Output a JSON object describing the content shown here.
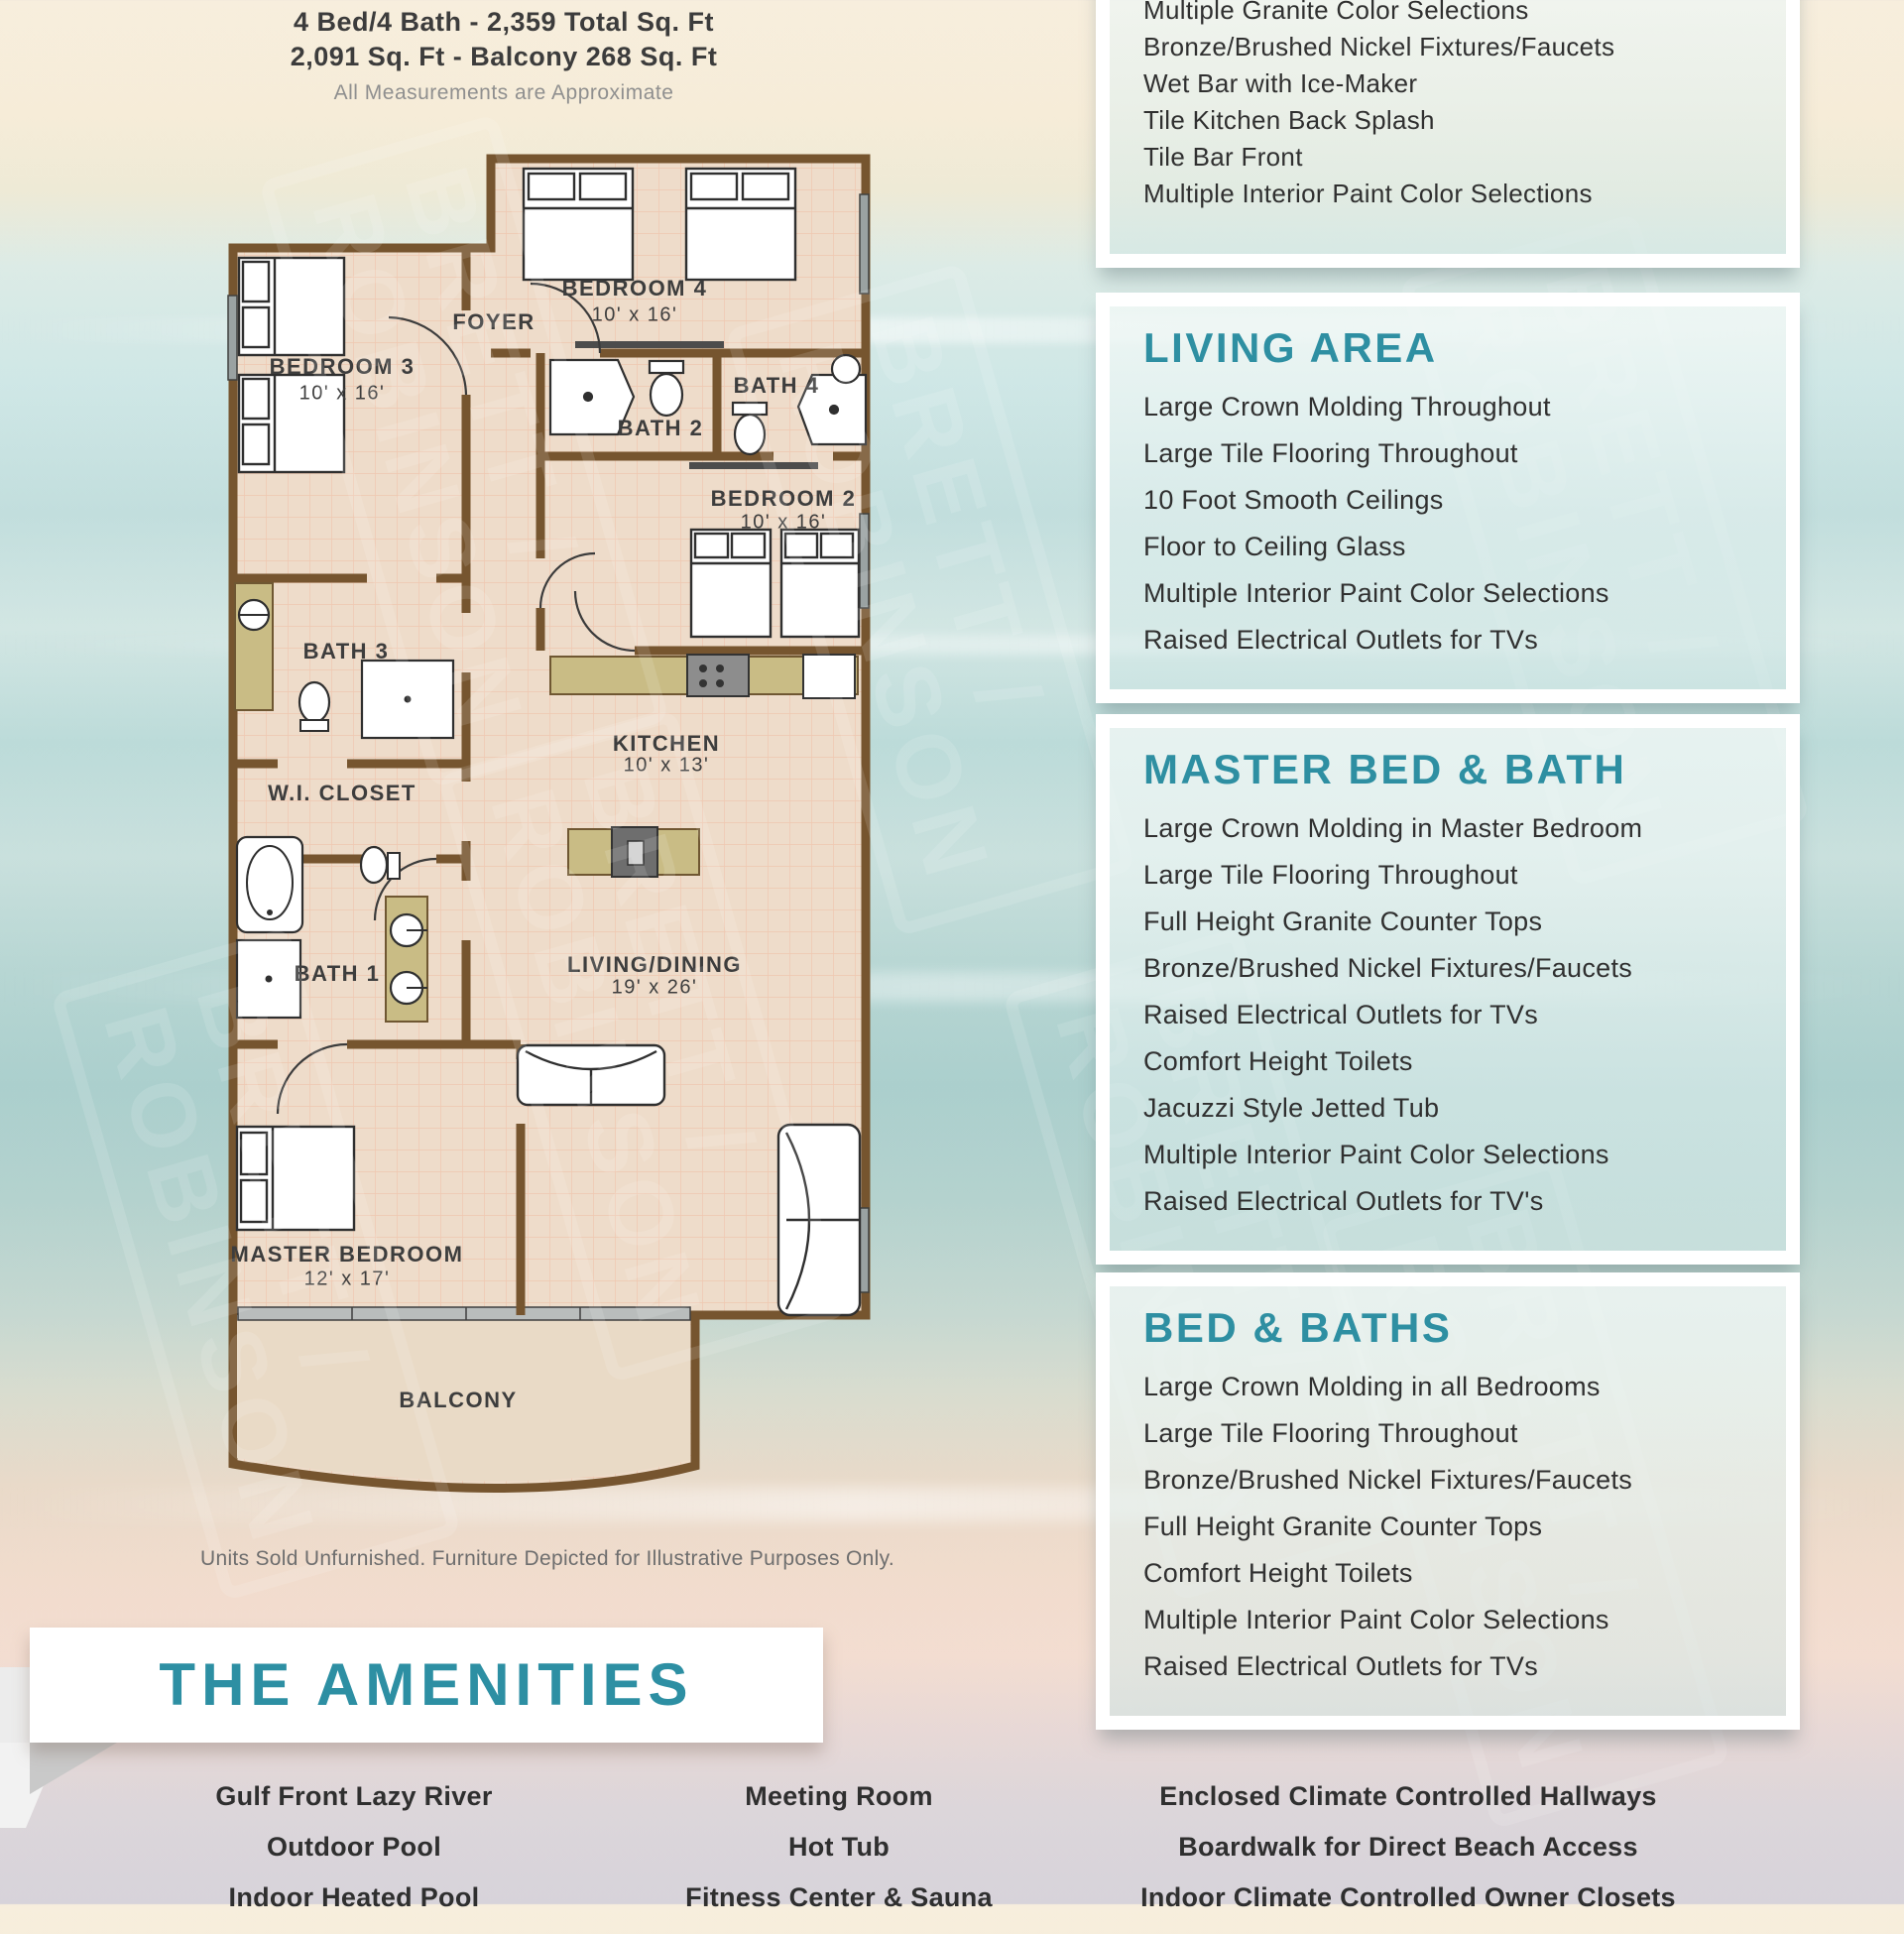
{
  "header": {
    "line1": "4 Bed/4 Bath - 2,359 Total Sq. Ft",
    "line2": "2,091 Sq. Ft - Balcony 268 Sq. Ft",
    "line3": "All Measurements are Approximate"
  },
  "floor_plan": {
    "rooms": [
      {
        "name": "BEDROOM 3",
        "dims": "10' x 16'"
      },
      {
        "name": "FOYER",
        "dims": ""
      },
      {
        "name": "BEDROOM 4",
        "dims": "10' x 16'"
      },
      {
        "name": "BATH 2",
        "dims": ""
      },
      {
        "name": "BATH 4",
        "dims": ""
      },
      {
        "name": "BEDROOM 2",
        "dims": "10' x 16'"
      },
      {
        "name": "BATH 3",
        "dims": ""
      },
      {
        "name": "KITCHEN",
        "dims": "10' x 13'"
      },
      {
        "name": "W.I. CLOSET",
        "dims": ""
      },
      {
        "name": "BATH 1",
        "dims": ""
      },
      {
        "name": "LIVING/DINING",
        "dims": "19' x 26'"
      },
      {
        "name": "MASTER BEDROOM",
        "dims": "12' x 17'"
      },
      {
        "name": "BALCONY",
        "dims": ""
      }
    ],
    "disclaimer": "Units Sold Unfurnished. Furniture Depicted for Illustrative Purposes Only."
  },
  "panels": [
    {
      "title": "",
      "items": [
        "Multiple Granite Color Selections",
        "Bronze/Brushed Nickel Fixtures/Faucets",
        "Wet Bar with Ice-Maker",
        "Tile Kitchen Back Splash",
        "Tile Bar Front",
        "Multiple Interior Paint Color Selections"
      ]
    },
    {
      "title": "LIVING AREA",
      "items": [
        "Large Crown Molding Throughout",
        "Large Tile Flooring Throughout",
        "10 Foot Smooth Ceilings",
        "Floor to Ceiling Glass",
        "Multiple Interior Paint Color Selections",
        "Raised Electrical Outlets for TVs"
      ]
    },
    {
      "title": "MASTER BED & BATH",
      "items": [
        "Large Crown Molding in Master Bedroom",
        "Large Tile Flooring Throughout",
        "Full Height Granite Counter Tops",
        "Bronze/Brushed Nickel Fixtures/Faucets",
        "Raised Electrical Outlets for TVs",
        "Comfort Height Toilets",
        "Jacuzzi Style Jetted Tub",
        "Multiple Interior Paint Color Selections",
        "Raised Electrical Outlets for TV's"
      ]
    },
    {
      "title": "BED & BATHS",
      "items": [
        "Large Crown Molding in all Bedrooms",
        "Large Tile Flooring Throughout",
        "Bronze/Brushed Nickel Fixtures/Faucets",
        "Full Height Granite Counter Tops",
        "Comfort Height Toilets",
        "Multiple Interior Paint Color Selections",
        "Raised Electrical Outlets for TVs"
      ]
    }
  ],
  "amenities": {
    "title": "THE AMENITIES",
    "columns": [
      [
        "Gulf Front Lazy River",
        "Outdoor Pool",
        "Indoor Heated Pool"
      ],
      [
        "Meeting Room",
        "Hot Tub",
        "Fitness Center & Sauna"
      ],
      [
        "Enclosed Climate Controlled Hallways",
        "Boardwalk for Direct Beach Access",
        "Indoor Climate Controlled Owner Closets"
      ]
    ]
  },
  "watermark": {
    "line1": "BRETT /",
    "line2": "ROBINSON"
  },
  "colors": {
    "heading_teal": "#2e8fa2",
    "wall_brown": "#76552f",
    "floor_beige": "#eedcca",
    "counter_olive": "#c9bc85",
    "cream": "#f7eedd"
  }
}
